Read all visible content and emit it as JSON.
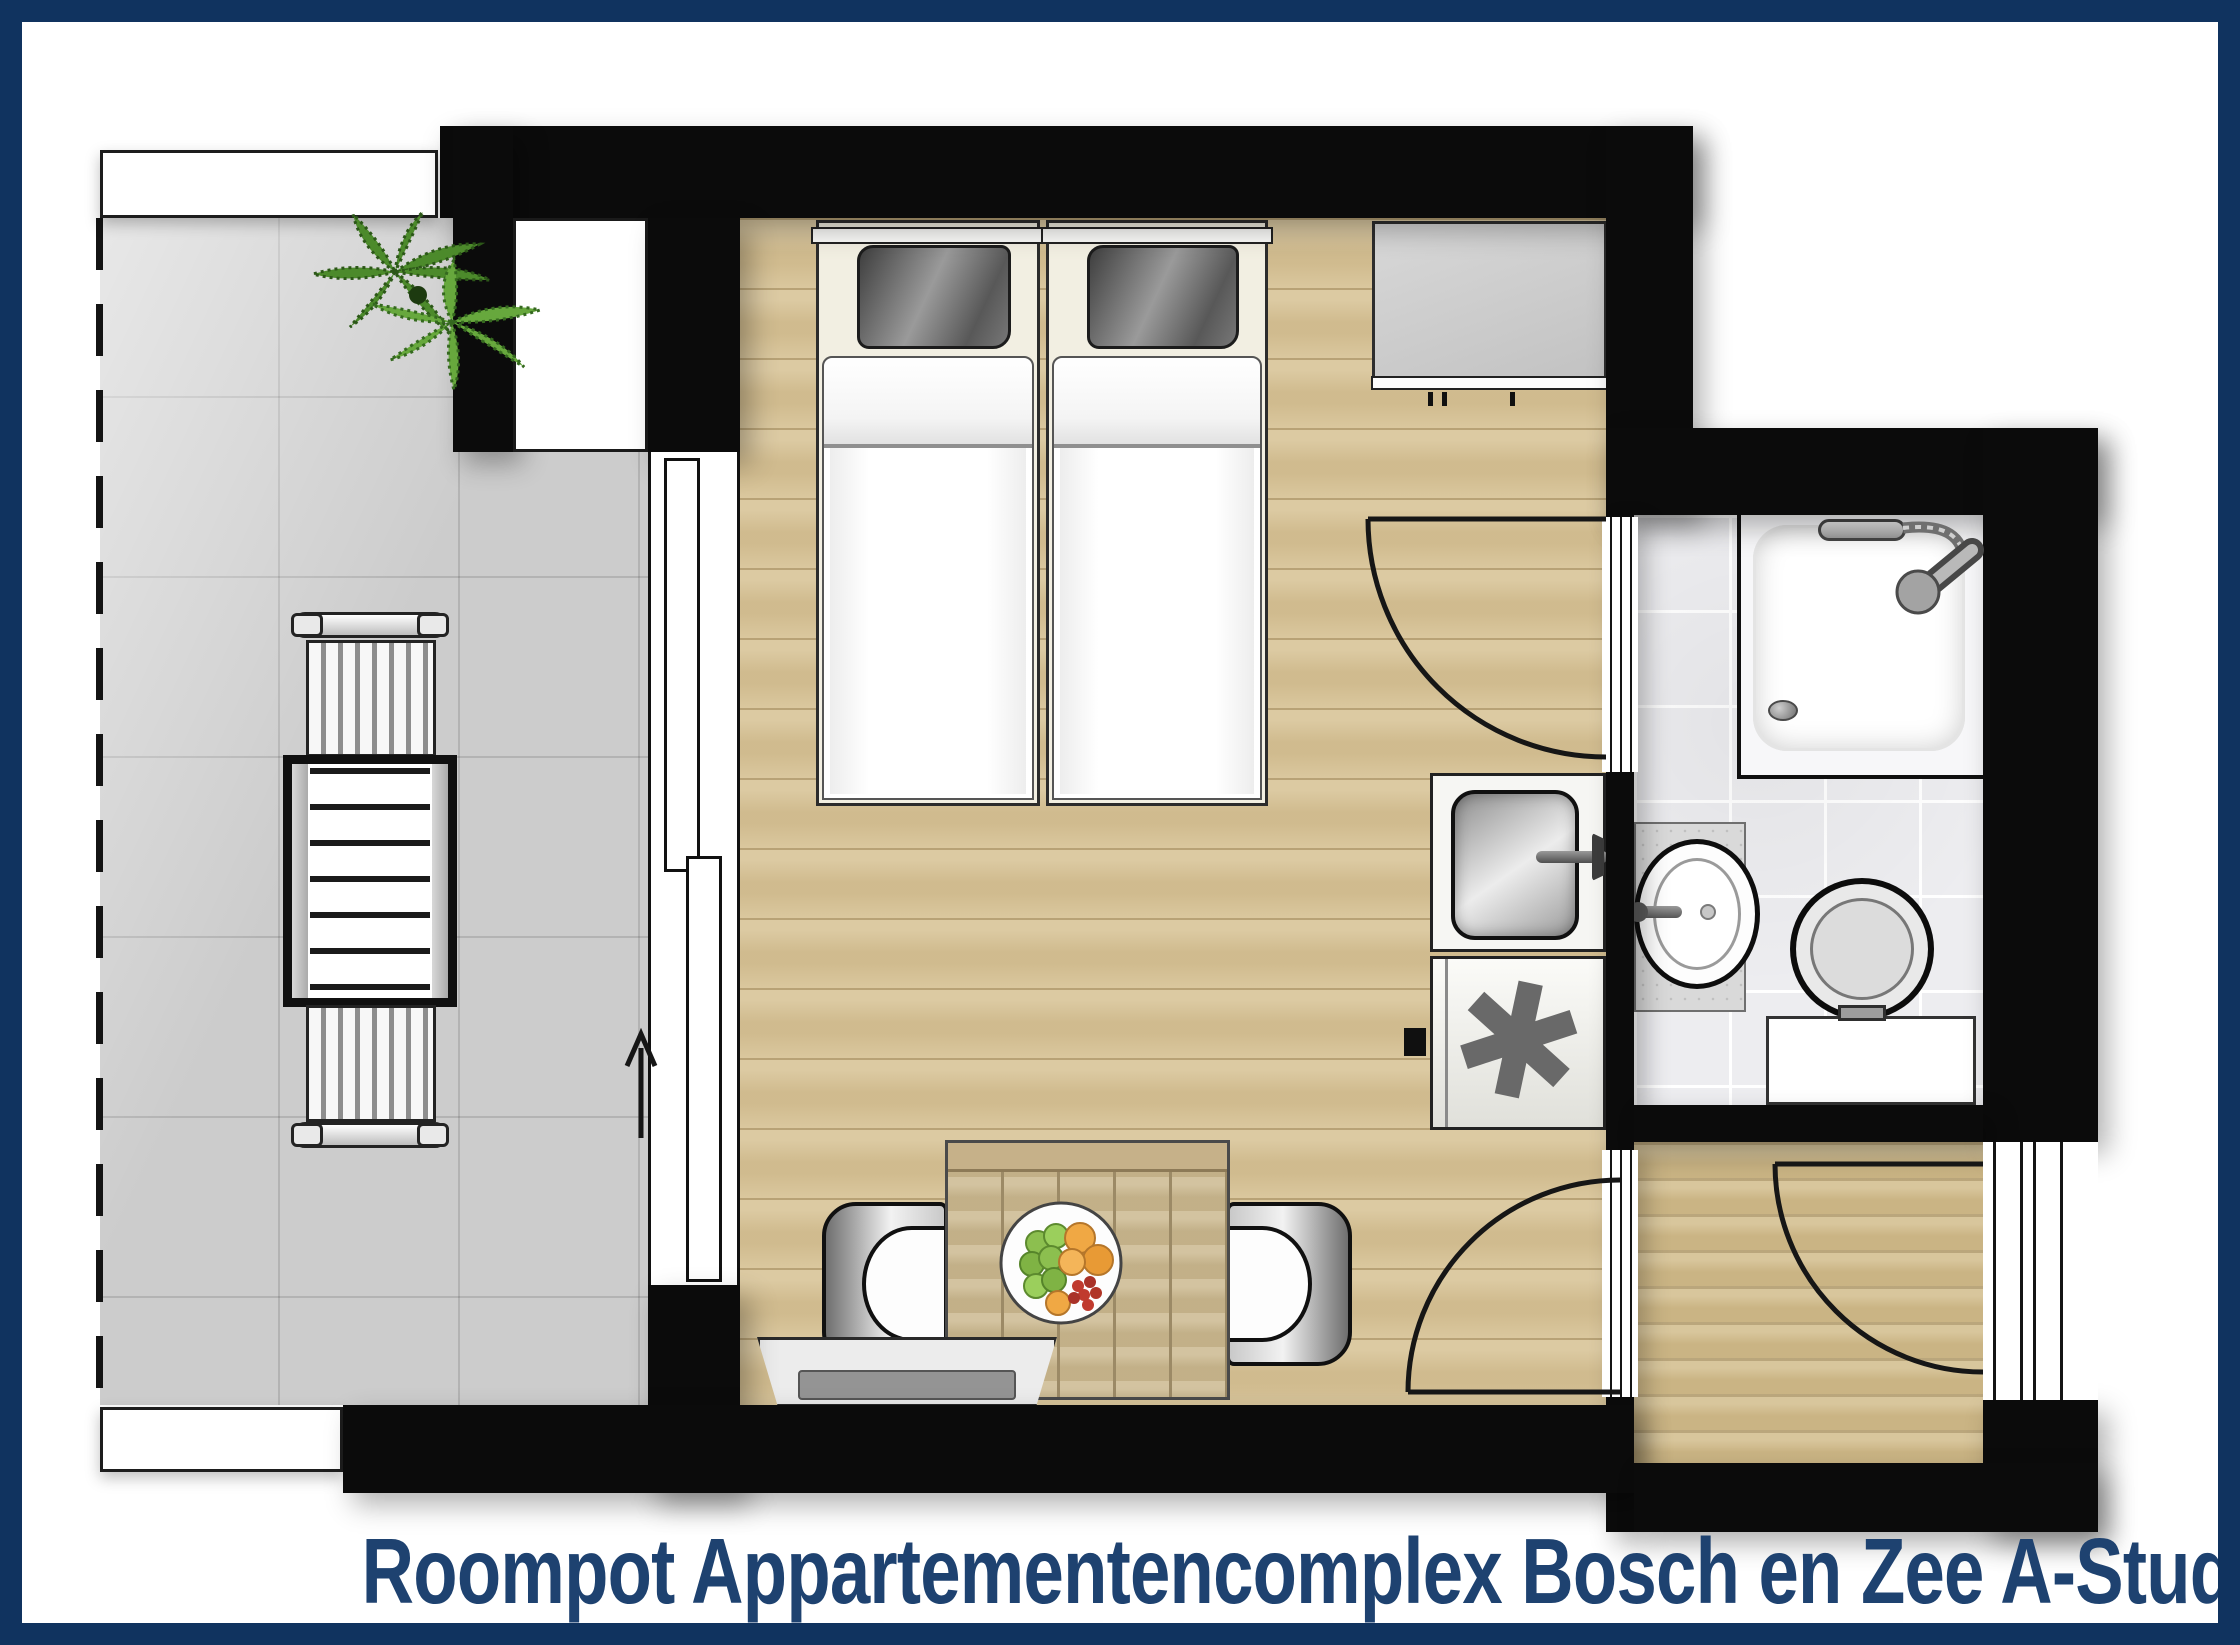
{
  "title": {
    "text": "Roompot Appartementencomplex Bosch en Zee A-Studi"
  },
  "icons": {
    "freezer_asterisk": "✱",
    "direction_arrow": "up-arrow",
    "plant": "potted-plant",
    "shower": "shower-tray-with-hand-shower",
    "washbasin": "round-basin-with-tap",
    "toilet": "toilet-with-cistern",
    "kitchen_sink": "square-sink-with-tap",
    "fruit_bowl": "bowl-with-grapes-oranges-berries"
  },
  "palette": {
    "frame_navy": "#10335f",
    "title_navy": "#1e4270",
    "wall_black": "#0b0b0b",
    "wood_floor": "#d8c498",
    "hall_floor": "#d3be8e",
    "balcony_gray": "#cccccc",
    "bathroom_tile": "#ededf0",
    "plant_green": "#5f9e3a",
    "pillow_gray": "#6f6f6f"
  }
}
